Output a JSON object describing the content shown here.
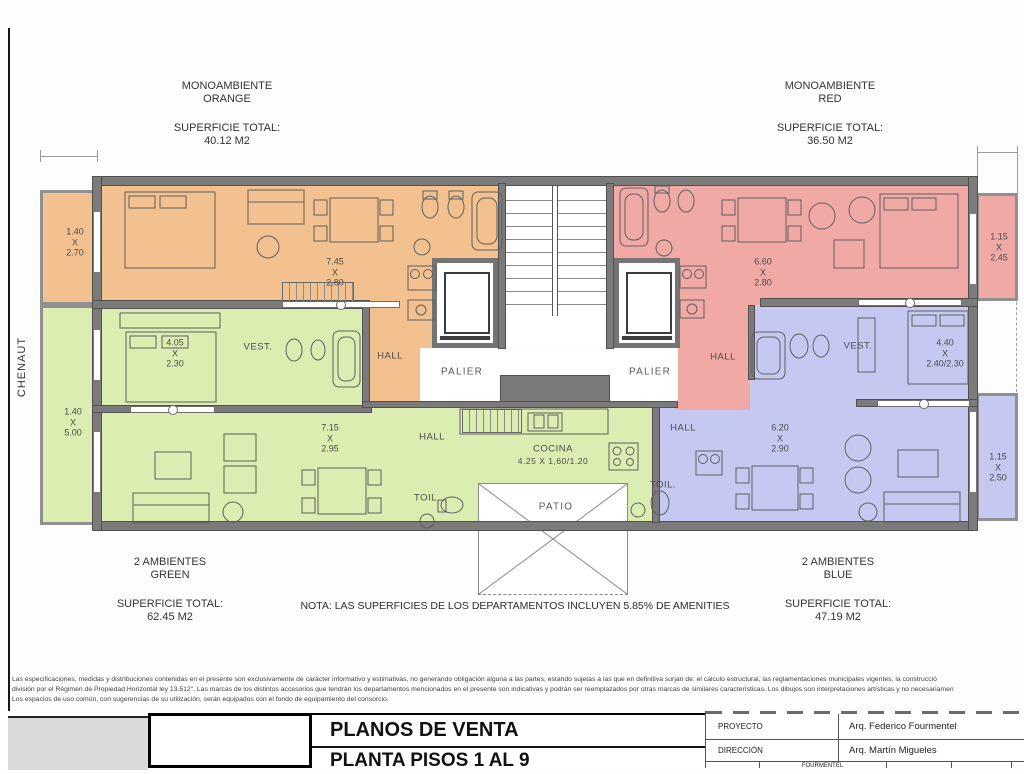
{
  "sheet": {
    "street_label": "CHENAUT",
    "note": "NOTA: LAS SUPERFICIES DE LOS DEPARTAMENTOS INCLUYEN 5.85% DE AMENITIES"
  },
  "units": {
    "orange": {
      "type": "MONOAMBIENTE",
      "name": "ORANGE",
      "superficie_label": "SUPERFICIE TOTAL:",
      "superficie_value": "40.12 M2"
    },
    "red": {
      "type": "MONOAMBIENTE",
      "name": "RED",
      "superficie_label": "SUPERFICIE TOTAL:",
      "superficie_value": "36.50 M2"
    },
    "green": {
      "type": "2 AMBIENTES",
      "name": "GREEN",
      "superficie_label": "SUPERFICIE TOTAL:",
      "superficie_value": "62.45 M2"
    },
    "blue": {
      "type": "2 AMBIENTES",
      "name": "BLUE",
      "superficie_label": "SUPERFICIE TOTAL:",
      "superficie_value": "47.19 M2"
    }
  },
  "plan": {
    "rooms": {
      "vest": "VEST.",
      "hall": "HALL",
      "palier": "PALIER",
      "toil": "TOIL.",
      "cocina": "COCINA",
      "cocina_dim": "4.25 X 1,60/1.20",
      "patio": "PATIO"
    },
    "dims": {
      "orange_balcony": "1.40\nX\n2.70",
      "orange_living": "7.45\nX\n2.80",
      "green_bedroom": "4.05\nX\n2.30",
      "green_balcony": "1.40\nX\n5.00",
      "green_living": "7.15\nX\n2.95",
      "red_living": "6.60\nX\n2.80",
      "red_balcony": "1.15\nX\n2.45",
      "blue_bedroom": "4.40\nX\n2.40/2.30",
      "blue_living": "6.20\nX\n2.90",
      "blue_balcony": "1.15\nX\n2.50"
    }
  },
  "disclaimer": {
    "line1": "Las especificaciones, medidas y distribuciones contenidas en el presente son exclusivamente de carácter informativo y estimativas, no generando obligación alguna a las partes, estando sujetas a las que en definitiva surjan de: el cálculo estructural, las reglamentaciones municipales vigentes, la construcció",
    "line2": "división por el Régimen de Propiedad Horizontal ley 13.512\". Las marcas de los distintos accesorios que tendrán los departamentos mencionados en el presente son indicativas y podrán ser reemplazados por otras marcas de similares características. Los dibujos son interpretaciones artísticas y no necesariamen",
    "line3": "Los espacios de uso común, con sugerencias de su utilización, serán equipados con el fondo de equipamiento del consorcio."
  },
  "title_block": {
    "title": "PLANOS DE VENTA",
    "subtitle": "PLANTA PISOS 1 AL 9",
    "rows": [
      {
        "label": "PROYECTO",
        "value": "Arq. Federico Fourmentel"
      },
      {
        "label": "DIRECCIÓN",
        "value": "Arq. Martín Migueles"
      }
    ],
    "partial_row_cell": "FOURMENTEL"
  },
  "colors": {
    "orange": "#f2c18f",
    "red": "#f1a9a5",
    "green": "#dcedb1",
    "blue": "#c5c8f0",
    "wall": "#7b7b7b"
  }
}
